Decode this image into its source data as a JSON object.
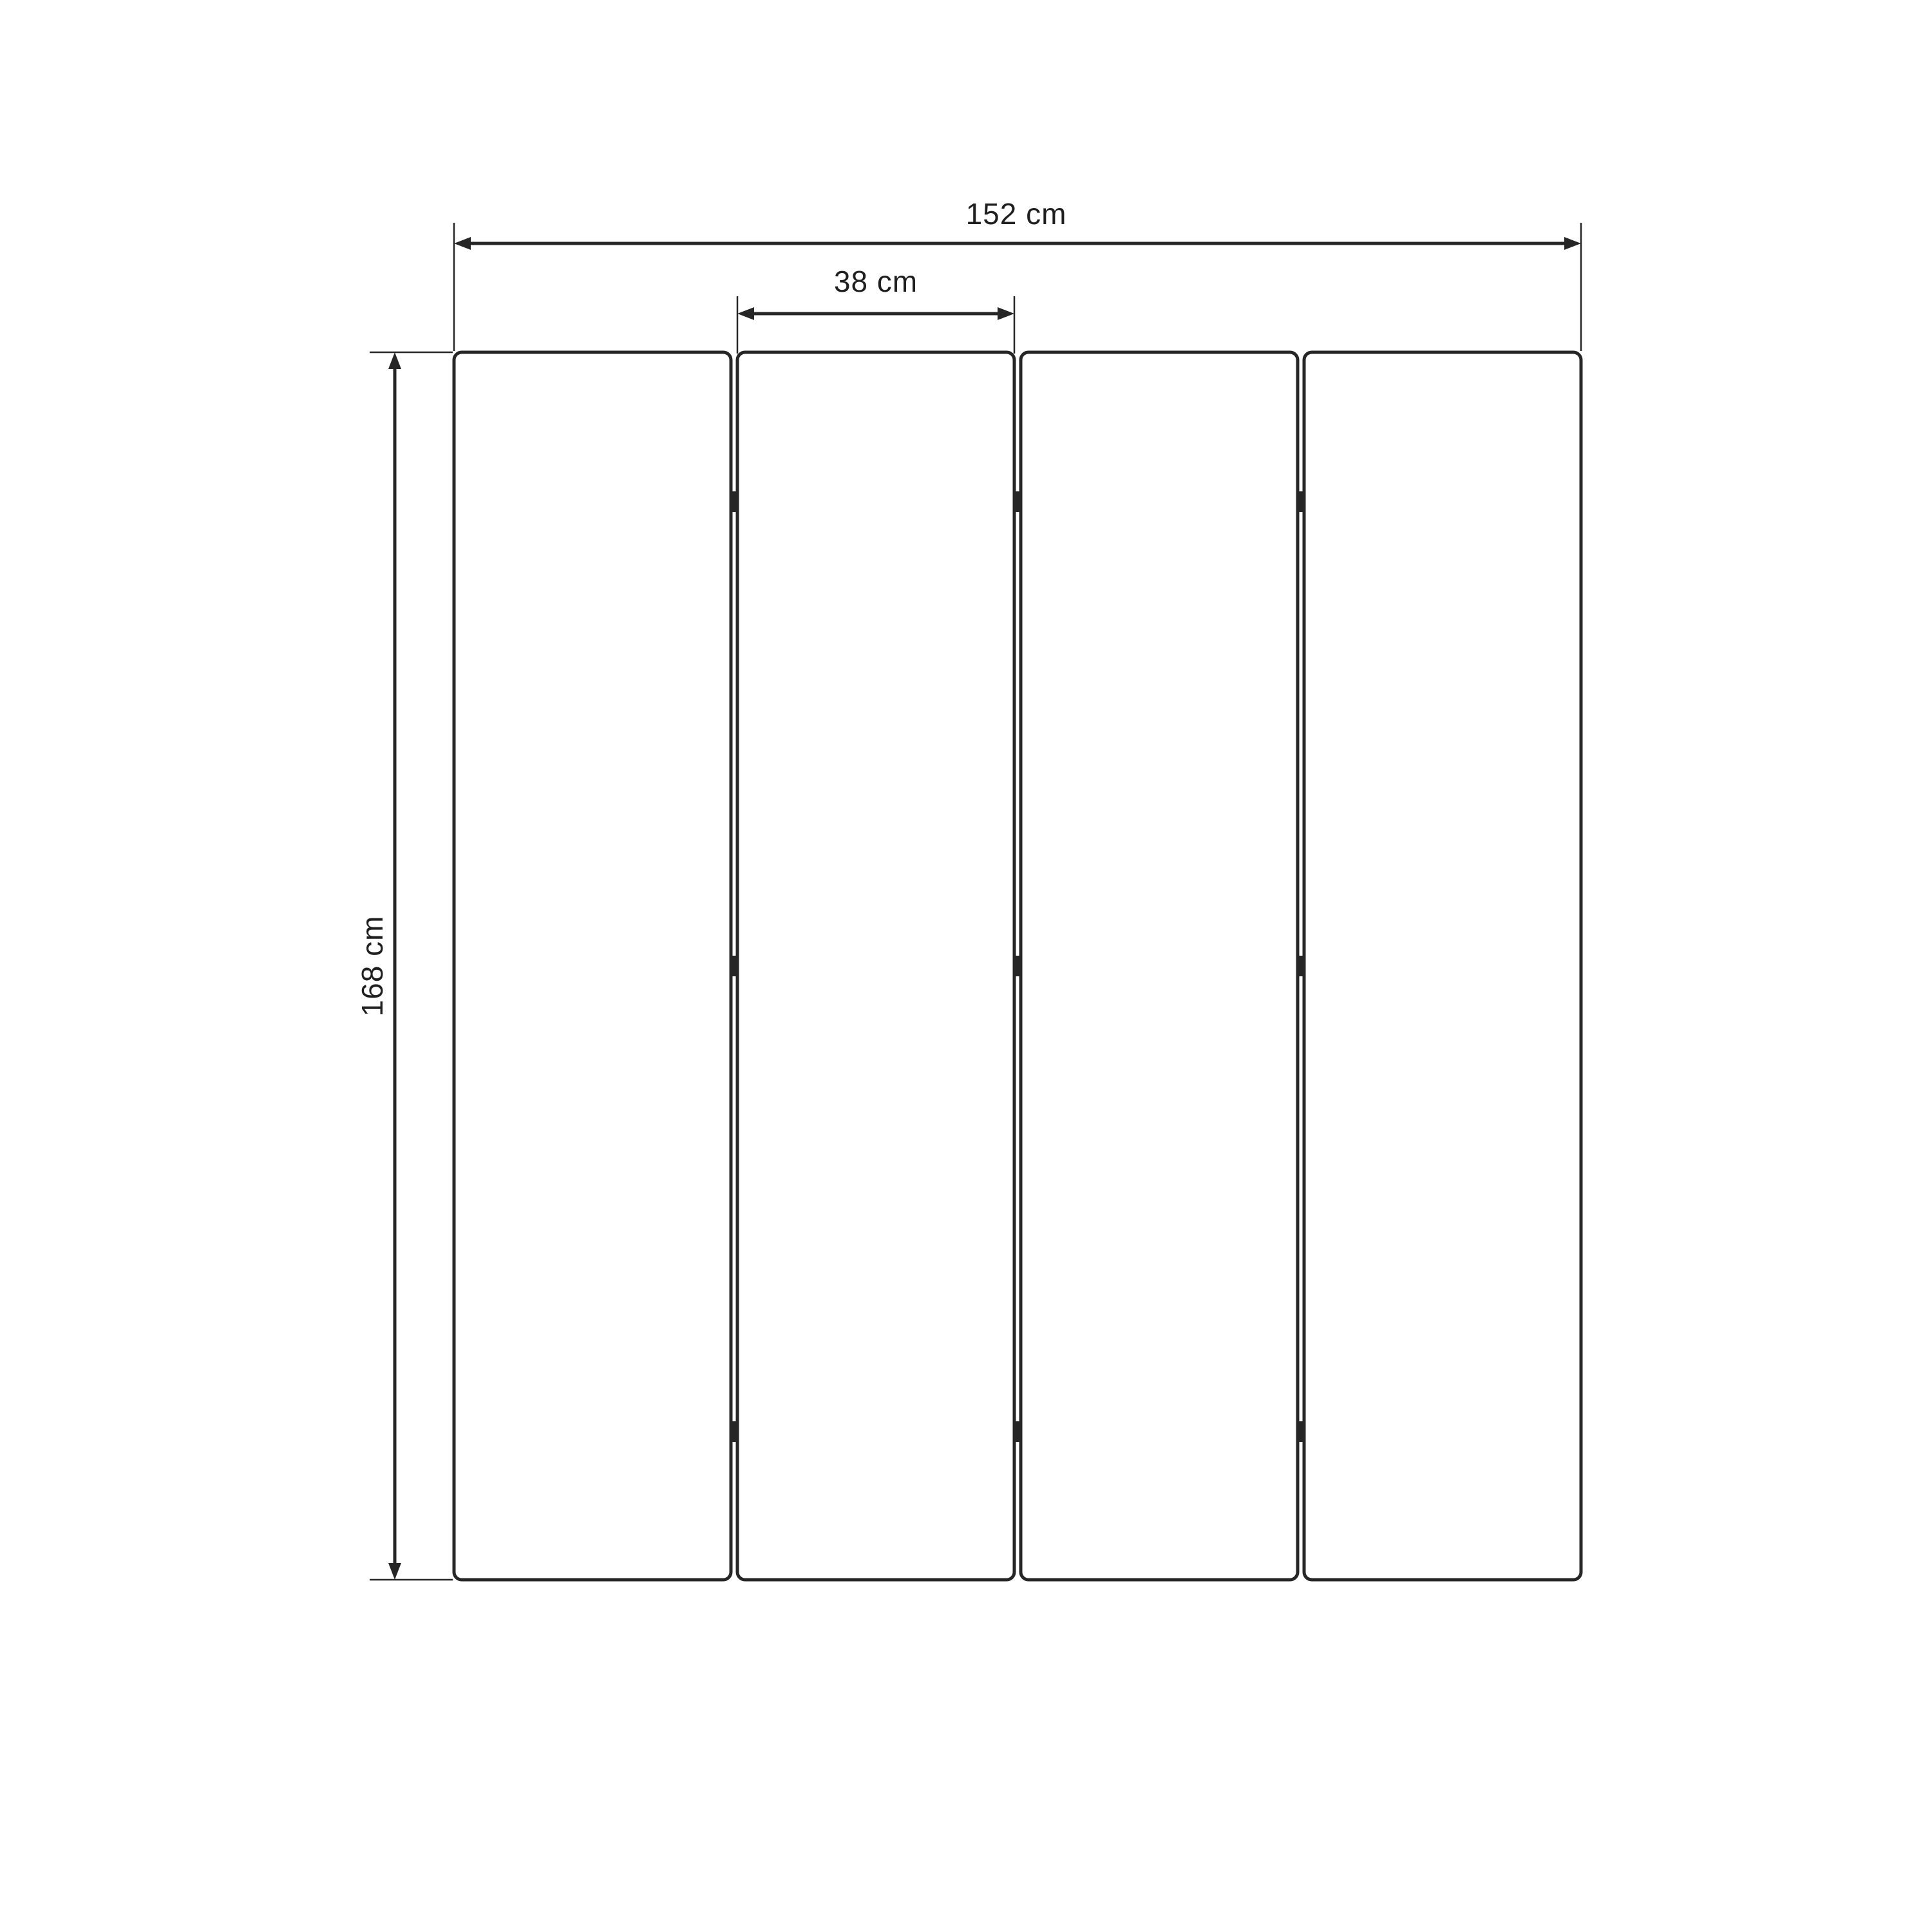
{
  "diagram": {
    "type": "dimension-drawing",
    "panel_count": 4,
    "hinge_rows": 3,
    "dimensions": {
      "total_width": {
        "label": "152 cm",
        "value": 152,
        "unit": "cm"
      },
      "panel_width": {
        "label": "38 cm",
        "value": 38,
        "unit": "cm"
      },
      "height": {
        "label": "168 cm",
        "value": 168,
        "unit": "cm"
      }
    },
    "colors": {
      "line": "#262626",
      "text": "#1f1f1f",
      "background": "#ffffff"
    }
  }
}
